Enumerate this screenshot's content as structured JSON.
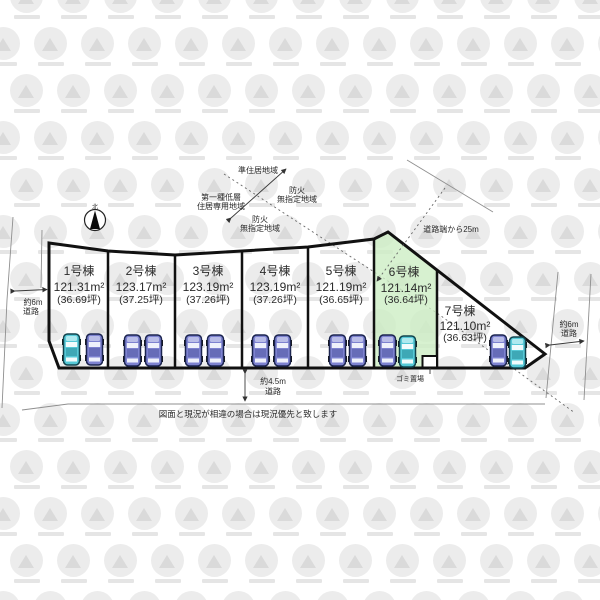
{
  "compass": {
    "north_label": "北"
  },
  "zoning": {
    "semi_residential_label": "準住居地域",
    "fire_right_line1": "防火",
    "fire_right_line2": "無指定地域",
    "first_kind_line1": "第一種低層",
    "first_kind_line2": "住居専用地域",
    "fire_left_line1": "防火",
    "fire_left_line2": "無指定地域",
    "road_distance_label": "道路端から25m"
  },
  "lots": [
    {
      "name": "1号棟",
      "area": "121.31m²",
      "tsubo": "(36.69坪)"
    },
    {
      "name": "2号棟",
      "area": "123.17m²",
      "tsubo": "(37.25坪)"
    },
    {
      "name": "3号棟",
      "area": "123.19m²",
      "tsubo": "(37.26坪)"
    },
    {
      "name": "4号棟",
      "area": "123.19m²",
      "tsubo": "(37.26坪)"
    },
    {
      "name": "5号棟",
      "area": "121.19m²",
      "tsubo": "(36.65坪)"
    },
    {
      "name": "6号棟",
      "area": "121.14m²",
      "tsubo": "(36.64坪)"
    },
    {
      "name": "7号棟",
      "area": "121.10m²",
      "tsubo": "(36.63坪)"
    }
  ],
  "roads": {
    "left": {
      "width_label": "約6m",
      "type_label": "道路"
    },
    "right": {
      "width_label": "約6m",
      "type_label": "道路"
    },
    "bottom": {
      "width_label": "約4.5m",
      "type_label": "道路"
    }
  },
  "garbage": {
    "label": "ゴミ置場"
  },
  "disclaimer": "図面と現況が相違の場合は現況優先と致します",
  "colors": {
    "highlight_green": "#cdeec4",
    "car_purple": "#7d82d0",
    "car_cyan": "#55c8d6"
  }
}
